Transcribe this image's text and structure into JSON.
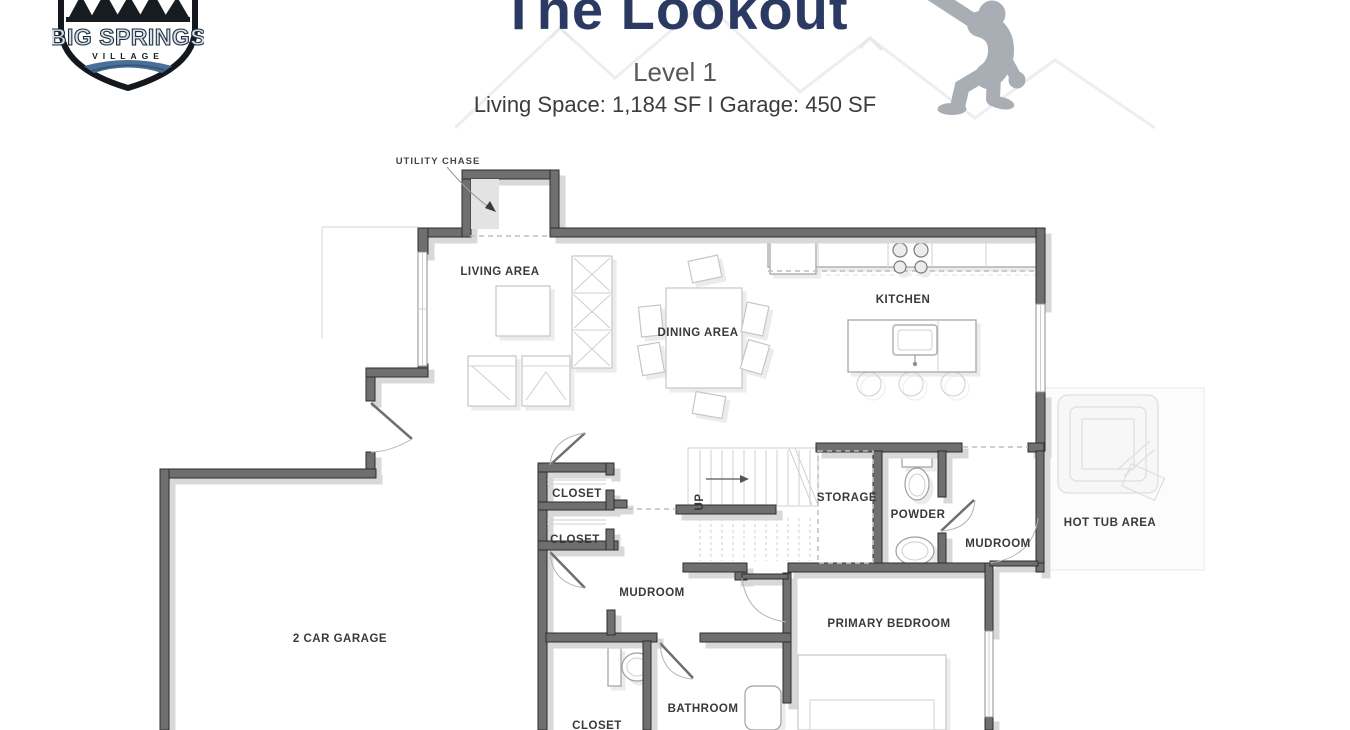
{
  "header": {
    "logo": {
      "line1": "BIG SPRINGS",
      "line2": "VILLAGE"
    },
    "title": "The Lookout",
    "subtitle": "Level 1",
    "specs": "Living Space: 1,184 SF I Garage: 450 SF"
  },
  "plan": {
    "labels": {
      "utility_chase": "UTILITY CHASE",
      "living_area": "LIVING AREA",
      "dining_area": "DINING AREA",
      "kitchen": "KITCHEN",
      "closet_1": "CLOSET",
      "closet_2": "CLOSET",
      "storage": "STORAGE",
      "powder": "POWDER",
      "mudroom_right": "MUDROOM",
      "mudroom_center": "MUDROOM",
      "hot_tub_area": "HOT TUB AREA",
      "garage": "2 CAR GARAGE",
      "primary_bedroom": "PRIMARY BEDROOM",
      "bathroom": "BATHROOM",
      "closet_bottom": "CLOSET",
      "stairs_direction": "UP"
    },
    "colors": {
      "title_navy": "#2b3a63",
      "wall_gray": "#6f6f6f",
      "wall_edge": "#2e2e2e",
      "shadow_gray": "#d8d8d8",
      "silhouette_gray": "#a9aeb4",
      "label_text": "#3a3a3a"
    }
  }
}
